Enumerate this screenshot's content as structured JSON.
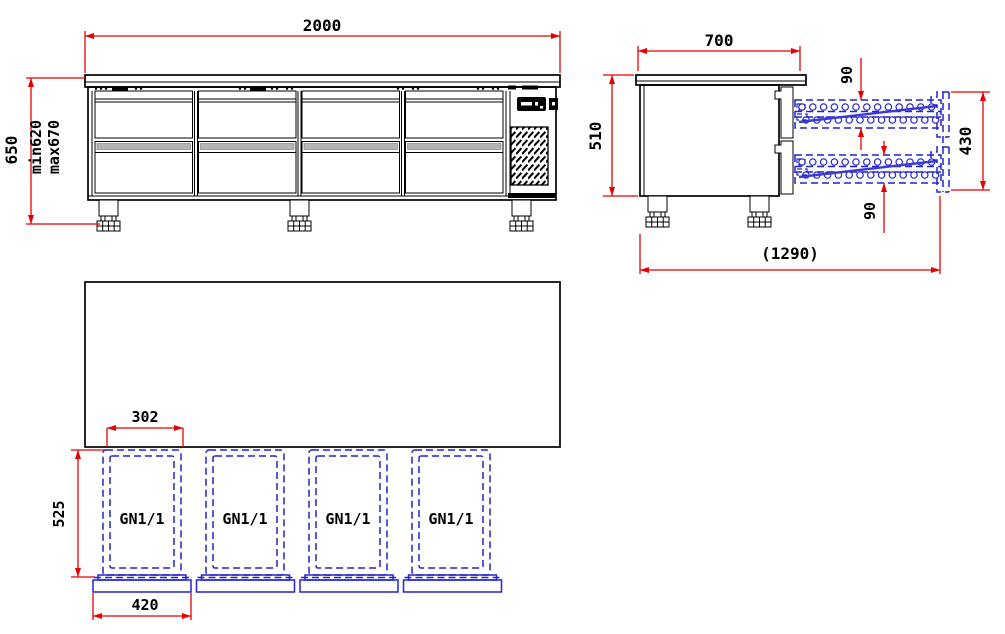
{
  "drawing": {
    "type": "technical-dimension-drawing",
    "views": {
      "front": {
        "width": "2000",
        "overall_height": "650",
        "height_min": "min620",
        "height_max": "max670"
      },
      "side": {
        "depth": "700",
        "body_height": "510",
        "upper_slide_height": "90",
        "lower_slide_height": "90",
        "drawer_zone_height": "430",
        "extended_depth": "(1290)"
      },
      "plan": {
        "pan_width": "302",
        "pan_depth": "525",
        "drawer_front_width": "420",
        "pan_labels": [
          "GN1/1",
          "GN1/1",
          "GN1/1",
          "GN1/1"
        ]
      }
    },
    "colors": {
      "dimension_line": "#e60000",
      "accessory_blue": "#2323cc",
      "object_line": "#000000"
    }
  }
}
